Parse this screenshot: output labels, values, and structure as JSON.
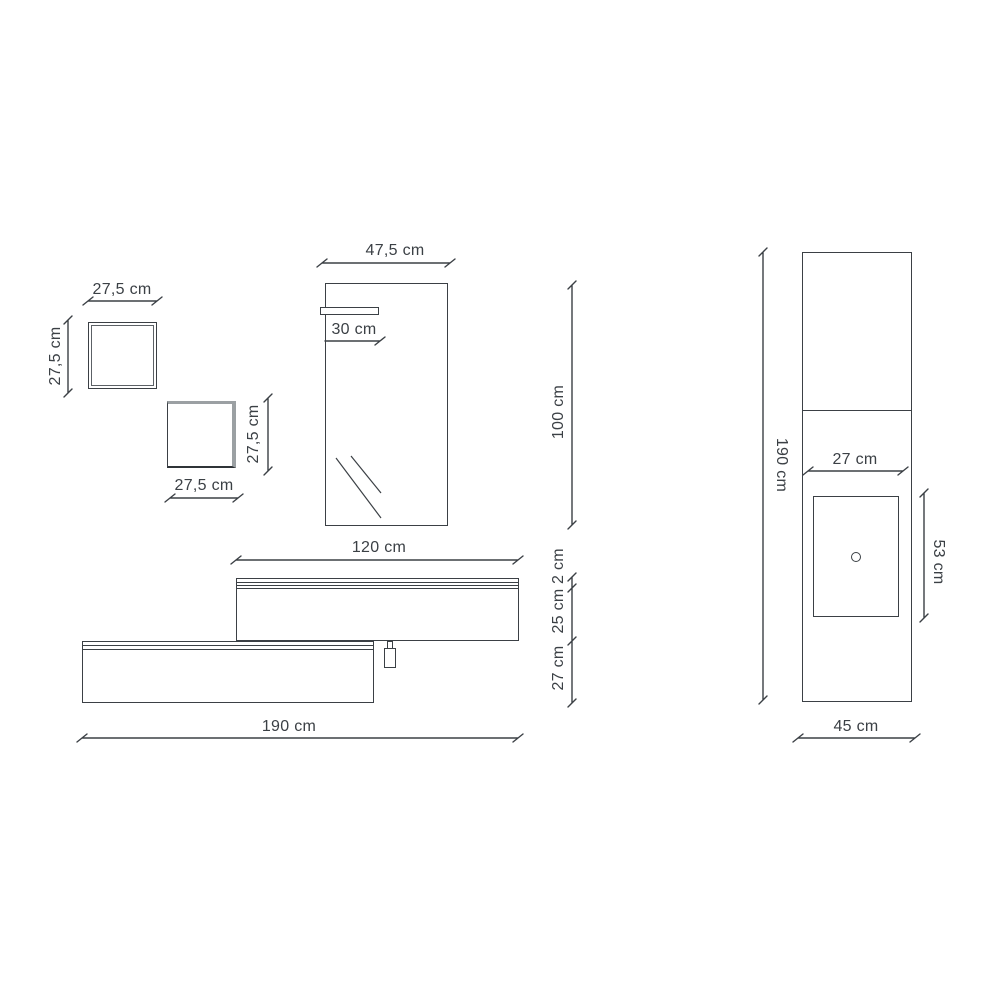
{
  "diagram": {
    "title": "Bathroom furniture dimensional drawing",
    "views": [
      "front elevation of wall cubes, mirror with shelf and cabinets",
      "side elevation of column with basin"
    ],
    "units": "cm",
    "line_color": "#3b4045",
    "shade_color": "#9ba0a3",
    "text_color": "#3b4045",
    "background": "#ffffff"
  },
  "labels": {
    "cube1_width": "27,5 cm",
    "cube1_height": "27,5 cm",
    "cube2_height": "27,5 cm",
    "cube2_width": "27,5 cm",
    "mirror_width": "47,5 cm",
    "mirror_shelf": "30 cm",
    "mirror_height": "100 cm",
    "upper_cabinet_width": "120 cm",
    "top_thickness": "2 cm",
    "upper_cabinet_height": "25 cm",
    "lower_cabinet_height": "27 cm",
    "total_width": "190 cm",
    "column_height": "190 cm",
    "basin_width": "27 cm",
    "basin_depth": "53 cm",
    "column_depth": "45 cm"
  },
  "components": [
    {
      "name": "wall-cube-1",
      "width_cm": 27.5,
      "height_cm": 27.5
    },
    {
      "name": "wall-cube-2",
      "width_cm": 27.5,
      "height_cm": 27.5
    },
    {
      "name": "mirror",
      "width_cm": 47.5,
      "height_cm": 100,
      "shelf_width_cm": 30
    },
    {
      "name": "upper-wall-cabinet",
      "width_cm": 120,
      "top_thickness_cm": 2,
      "body_height_cm": 25
    },
    {
      "name": "lower-wall-cabinet",
      "height_cm": 27,
      "assembly_total_width_cm": 190
    },
    {
      "name": "side-column-with-basin",
      "height_cm": 190,
      "depth_cm": 45,
      "basin_width_cm": 27,
      "basin_depth_cm": 53
    }
  ]
}
